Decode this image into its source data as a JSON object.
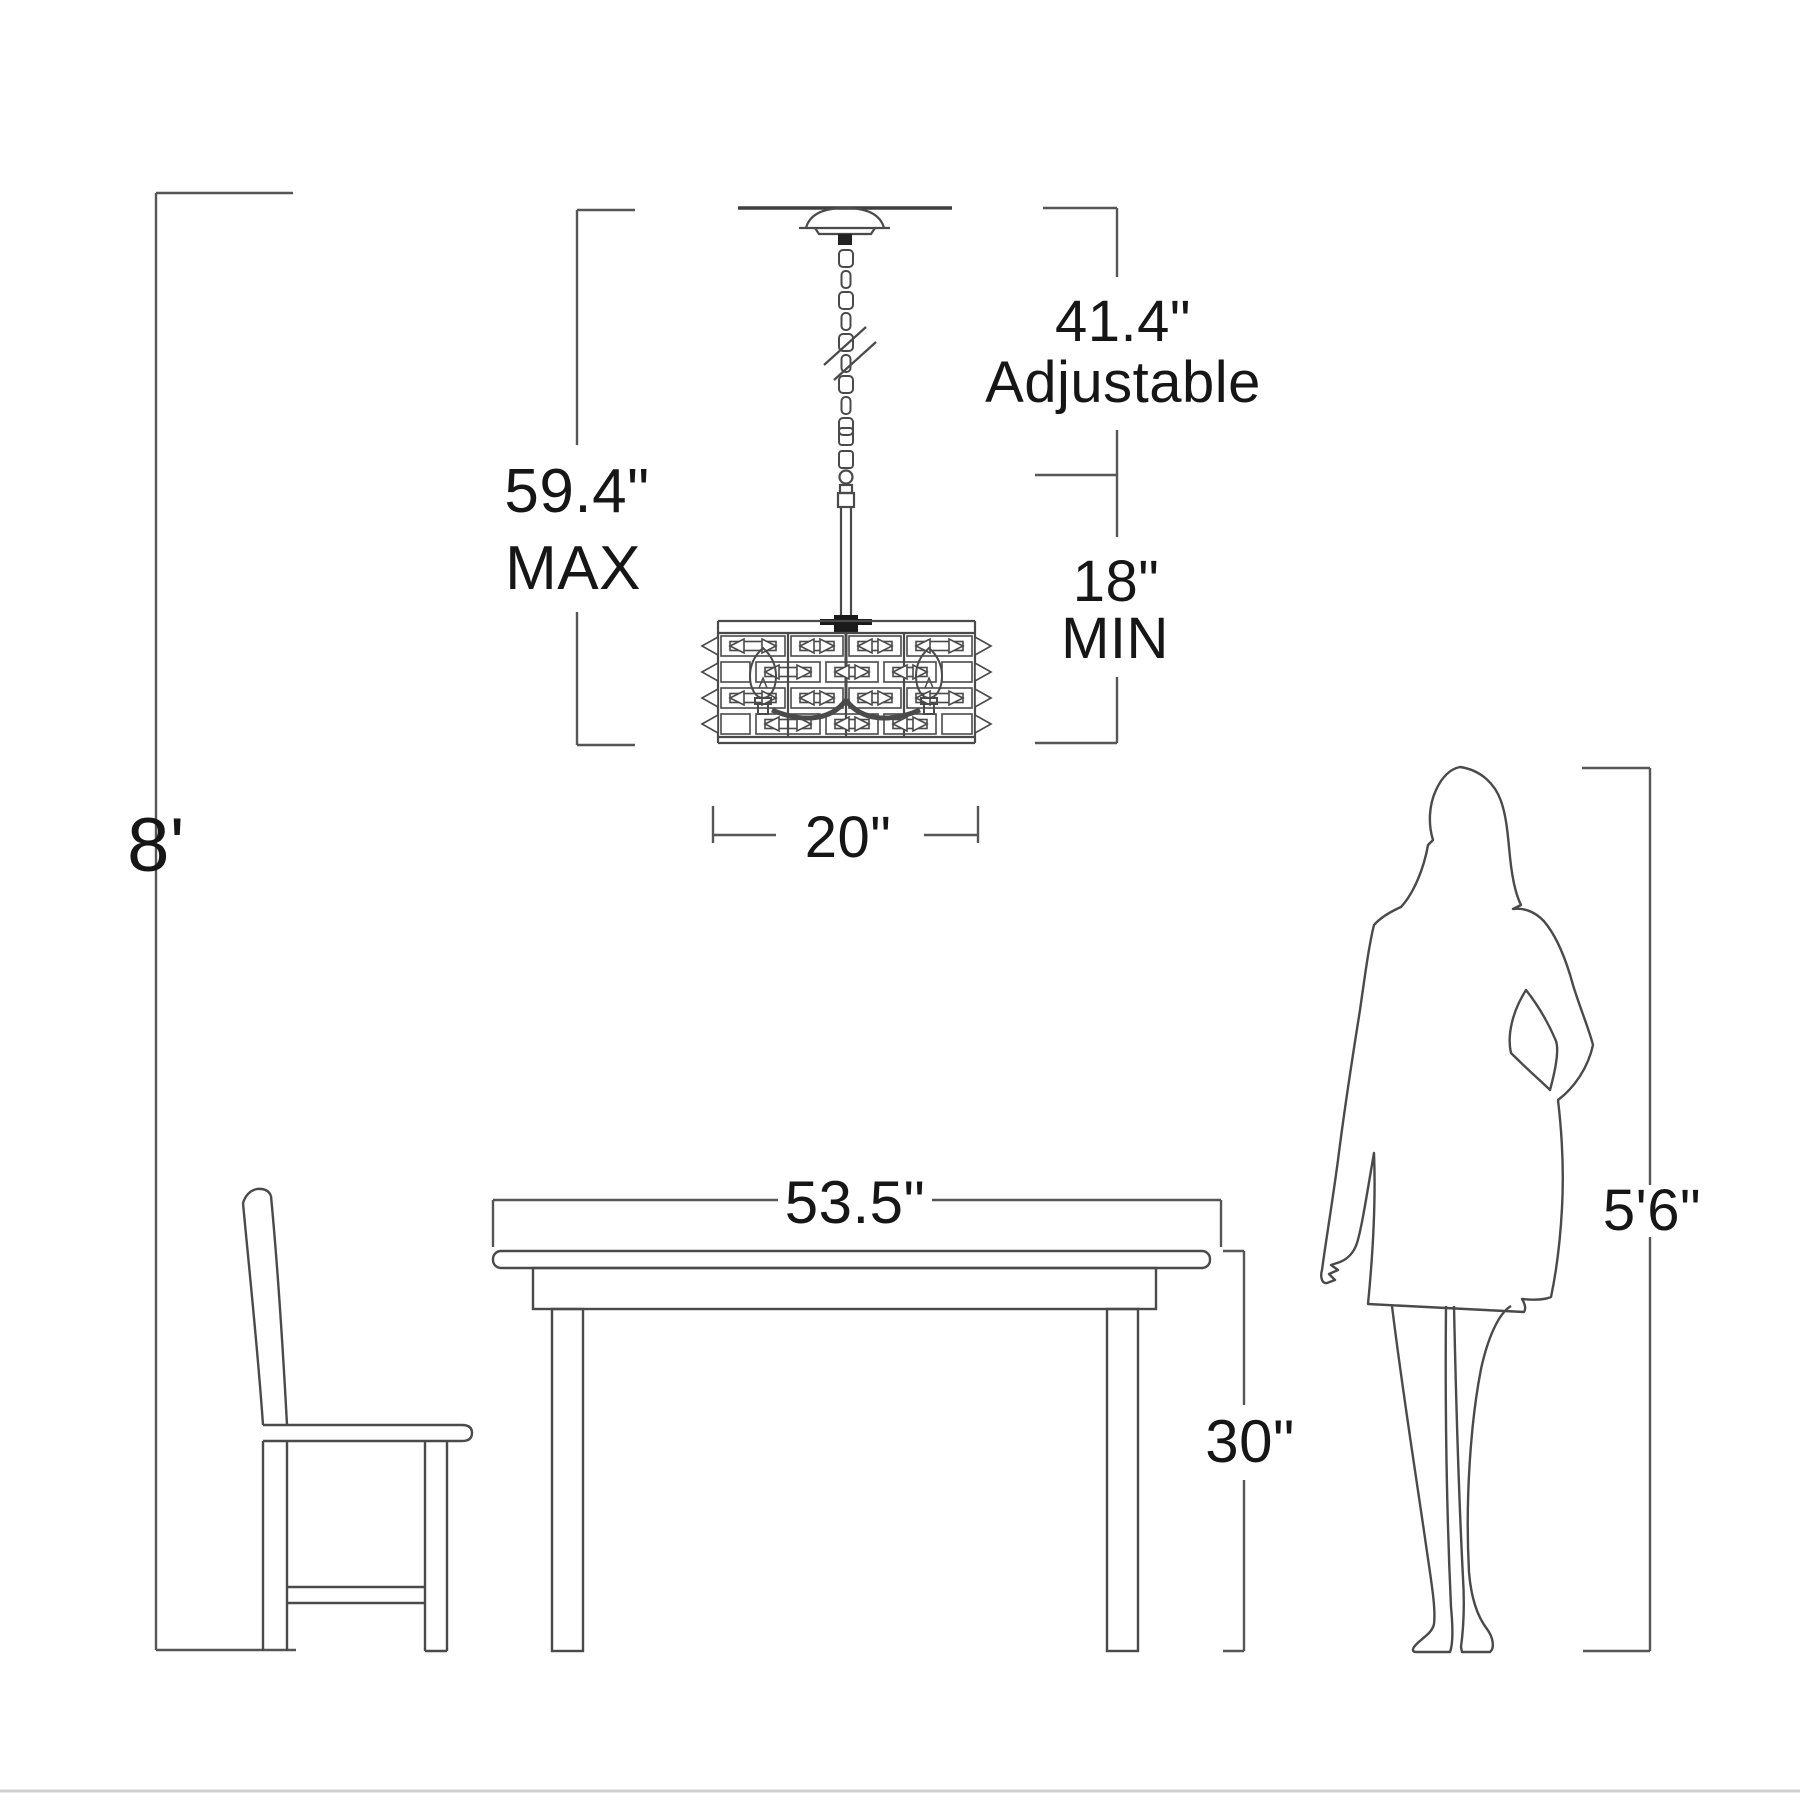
{
  "drawing": {
    "type": "product-dimension-diagram",
    "subject": "chandelier over dining table with chair and human figure for scale",
    "line_color": "#4a4a4a",
    "text_color": "#161616",
    "background": "#ffffff"
  },
  "labels": {
    "ceiling_height": "8'",
    "max_value": "59.4\"",
    "max_word": "MAX",
    "adjustable_value": "41.4\"",
    "adjustable_word": "Adjustable",
    "min_value": "18\"",
    "min_word": "MIN",
    "fixture_width": "20\"",
    "table_width": "53.5\"",
    "table_height": "30\"",
    "person_height": "5'6\""
  }
}
